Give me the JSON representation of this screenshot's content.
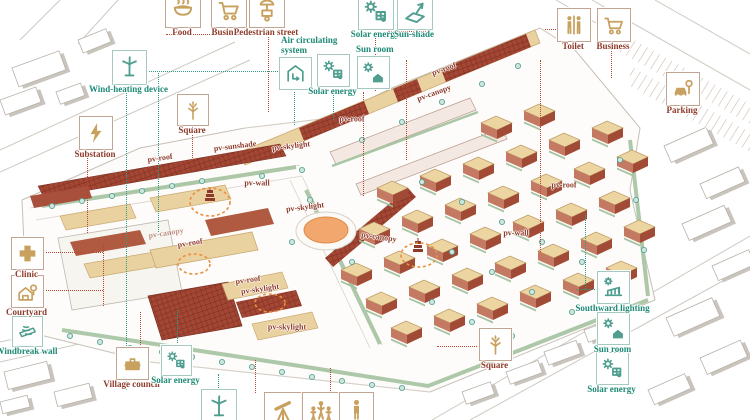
{
  "diagram": {
    "title": "Village masterplan energy-strategy axonometric diagram",
    "colors": {
      "teal_label": "#1e8a76",
      "red_label": "#8f3b2b",
      "tan_icon": "#c8a15e",
      "teal_icon": "#4f9e8f",
      "orange": "#e8913f",
      "pv_red": "#a34634",
      "roof_tan": "#ead1a0",
      "green_band": "#a9c6a4"
    },
    "callouts": [
      {
        "id": "food",
        "label": "Food",
        "icon": "food",
        "color": "red",
        "icon_color": "tan",
        "x": 165,
        "y": -8,
        "s": 34,
        "label_pos": "below"
      },
      {
        "id": "business-top",
        "label": "Business",
        "icon": "cart",
        "color": "red",
        "icon_color": "tan",
        "x": 211,
        "y": -8,
        "s": 34,
        "label_pos": "below"
      },
      {
        "id": "pedestrian-street",
        "label": "Pedestrian street",
        "icon": "vendor-cart",
        "color": "red",
        "icon_color": "tan",
        "x": 249,
        "y": -8,
        "s": 34,
        "label_pos": "below"
      },
      {
        "id": "solar-energy-top",
        "label": "Solar energy",
        "icon": "solar-panel",
        "color": "teal",
        "icon_color": "teal",
        "x": 358,
        "y": -6,
        "s": 34,
        "label_pos": "below"
      },
      {
        "id": "sun-shade",
        "label": "Sun-shade",
        "icon": "sun-shade",
        "color": "teal",
        "icon_color": "teal",
        "x": 397,
        "y": -6,
        "s": 34,
        "label_pos": "below"
      },
      {
        "id": "toilet",
        "label": "Toilet",
        "icon": "toilet",
        "color": "red",
        "icon_color": "tan",
        "x": 557,
        "y": 8,
        "s": 32,
        "label_pos": "below"
      },
      {
        "id": "business-right",
        "label": "Business",
        "icon": "cart",
        "color": "red",
        "icon_color": "tan",
        "x": 597,
        "y": 8,
        "s": 32,
        "label_pos": "below"
      },
      {
        "id": "parking",
        "label": "Parking",
        "icon": "car",
        "color": "red",
        "icon_color": "tan",
        "x": 666,
        "y": 72,
        "s": 32,
        "label_pos": "below"
      },
      {
        "id": "wind-heating",
        "label": "Wind-heating device",
        "icon": "wind-turbine",
        "color": "teal",
        "icon_color": "teal",
        "x": 112,
        "y": 50,
        "s": 33,
        "label_pos": "below"
      },
      {
        "id": "substation",
        "label": "Substation",
        "icon": "lightning",
        "color": "red",
        "icon_color": "tan",
        "x": 79,
        "y": 116,
        "s": 32,
        "label_pos": "below"
      },
      {
        "id": "square-left",
        "label": "Square",
        "icon": "tree",
        "color": "red",
        "icon_color": "tan",
        "x": 177,
        "y": 94,
        "s": 30,
        "label_pos": "below"
      },
      {
        "id": "air-circulating",
        "label": "Air circulating system",
        "icon": "air-house",
        "color": "teal",
        "icon_color": "teal",
        "x": 279,
        "y": 57,
        "s": 31,
        "label_pos": "above2"
      },
      {
        "id": "solar-energy-mid",
        "label": "Solar energy",
        "icon": "solar-panel",
        "color": "teal",
        "icon_color": "teal",
        "x": 317,
        "y": 54,
        "s": 31,
        "label_pos": "below"
      },
      {
        "id": "sun-room-mid",
        "label": "Sun room",
        "icon": "sun-house",
        "color": "teal",
        "icon_color": "teal",
        "x": 357,
        "y": 56,
        "s": 31,
        "label_pos": "above"
      },
      {
        "id": "clinic",
        "label": "Clinic",
        "icon": "cross",
        "color": "red",
        "icon_color": "tan",
        "x": 11,
        "y": 237,
        "s": 31,
        "label_pos": "below"
      },
      {
        "id": "courtyard",
        "label": "Courtyard",
        "icon": "courtyard-house",
        "color": "red",
        "icon_color": "tan",
        "x": 11,
        "y": 275,
        "s": 31,
        "label_pos": "below"
      },
      {
        "id": "windbreak-wall",
        "label": "Windbreak wall",
        "icon": "windbreak",
        "color": "teal",
        "icon_color": "teal",
        "x": 12,
        "y": 316,
        "s": 29,
        "label_pos": "below"
      },
      {
        "id": "village-council",
        "label": "Village council",
        "icon": "briefcase",
        "color": "red",
        "icon_color": "tan",
        "x": 116,
        "y": 347,
        "s": 31,
        "label_pos": "below"
      },
      {
        "id": "solar-energy-bl",
        "label": "Solar energy",
        "icon": "solar-panel",
        "color": "teal",
        "icon_color": "teal",
        "x": 161,
        "y": 345,
        "s": 29,
        "label_pos": "below"
      },
      {
        "id": "southward-lighting",
        "label": "Southward lighting",
        "icon": "south-light",
        "color": "teal",
        "icon_color": "teal",
        "x": 597,
        "y": 271,
        "s": 31,
        "label_pos": "below"
      },
      {
        "id": "sun-room-right",
        "label": "Sun room",
        "icon": "sun-house",
        "color": "teal",
        "icon_color": "teal",
        "x": 597,
        "y": 312,
        "s": 31,
        "label_pos": "below"
      },
      {
        "id": "solar-energy-right",
        "label": "Solar energy",
        "icon": "solar-panel",
        "color": "teal",
        "icon_color": "teal",
        "x": 596,
        "y": 352,
        "s": 31,
        "label_pos": "below"
      },
      {
        "id": "square-bottom",
        "label": "Square",
        "icon": "tree",
        "color": "red",
        "icon_color": "tan",
        "x": 479,
        "y": 328,
        "s": 31,
        "label_pos": "below"
      },
      {
        "id": "turbine-bottom",
        "label": "",
        "icon": "wind-turbine",
        "color": "teal",
        "icon_color": "teal",
        "x": 201,
        "y": 389,
        "s": 34,
        "label_pos": "none"
      },
      {
        "id": "telescope-bottom",
        "label": "",
        "icon": "telescope",
        "color": "red",
        "icon_color": "tan",
        "x": 264,
        "y": 392,
        "s": 36,
        "label_pos": "none"
      },
      {
        "id": "people-bottom",
        "label": "",
        "icon": "people",
        "color": "red",
        "icon_color": "tan",
        "x": 302,
        "y": 392,
        "s": 36,
        "label_pos": "none"
      },
      {
        "id": "person-bottom",
        "label": "",
        "icon": "person",
        "color": "red",
        "icon_color": "tan",
        "x": 339,
        "y": 392,
        "s": 33,
        "label_pos": "none"
      }
    ],
    "plan_labels": [
      {
        "text": "pv-roof",
        "x": 160,
        "y": 158,
        "rot": -8
      },
      {
        "text": "pv-sunshade",
        "x": 235,
        "y": 146,
        "rot": -7
      },
      {
        "text": "pv-skylight",
        "x": 291,
        "y": 146,
        "rot": -7
      },
      {
        "text": "pv-wall",
        "x": 257,
        "y": 183,
        "rot": 0
      },
      {
        "text": "pv-canopy",
        "x": 166,
        "y": 233,
        "rot": -9,
        "faint": true
      },
      {
        "text": "pv-roof",
        "x": 190,
        "y": 243,
        "rot": -9
      },
      {
        "text": "pv-roof",
        "x": 248,
        "y": 280,
        "rot": -8
      },
      {
        "text": "pv-skylight",
        "x": 260,
        "y": 289,
        "rot": -8
      },
      {
        "text": "pv-skylight",
        "x": 287,
        "y": 327,
        "rot": 0
      },
      {
        "text": "pv-skylight",
        "x": 305,
        "y": 207,
        "rot": -7
      },
      {
        "text": "pv-canopy",
        "x": 379,
        "y": 237,
        "rot": 8
      },
      {
        "text": "pv-roof",
        "x": 444,
        "y": 69,
        "rot": -20
      },
      {
        "text": "pv-canopy",
        "x": 434,
        "y": 93,
        "rot": -20
      },
      {
        "text": "pv-roof",
        "x": 352,
        "y": 119,
        "rot": 0
      },
      {
        "text": "pv-roof",
        "x": 564,
        "y": 185,
        "rot": 0
      },
      {
        "text": "pv-wall",
        "x": 516,
        "y": 233,
        "rot": 0
      }
    ],
    "connectors": [
      {
        "x": 166,
        "y": 34,
        "len": 82,
        "dir": "h",
        "c": "red"
      },
      {
        "x": 268,
        "y": 34,
        "len": 78,
        "dir": "v",
        "c": "red"
      },
      {
        "x": 375,
        "y": 33,
        "len": 58,
        "dir": "v",
        "c": "red"
      },
      {
        "x": 388,
        "y": 31,
        "len": 40,
        "dir": "h",
        "c": "red"
      },
      {
        "x": 545,
        "y": 29,
        "len": 13,
        "dir": "h",
        "c": "red"
      },
      {
        "x": 611,
        "y": 47,
        "len": 31,
        "dir": "v",
        "c": "red"
      },
      {
        "x": 87,
        "y": 153,
        "len": 80,
        "dir": "v",
        "c": "red"
      },
      {
        "x": 192,
        "y": 126,
        "len": 34,
        "dir": "v",
        "c": "red"
      },
      {
        "x": 43,
        "y": 252,
        "len": 60,
        "dir": "h",
        "c": "red"
      },
      {
        "x": 103,
        "y": 244,
        "len": 62,
        "dir": "v",
        "c": "red"
      },
      {
        "x": 44,
        "y": 290,
        "len": 59,
        "dir": "h",
        "c": "red"
      },
      {
        "x": 437,
        "y": 346,
        "len": 42,
        "dir": "h",
        "c": "red"
      },
      {
        "x": 140,
        "y": 312,
        "len": 35,
        "dir": "v",
        "c": "red"
      },
      {
        "x": 255,
        "y": 360,
        "len": 33,
        "dir": "v",
        "c": "red"
      },
      {
        "x": 330,
        "y": 368,
        "len": 25,
        "dir": "v",
        "c": "red"
      },
      {
        "x": 363,
        "y": 92,
        "len": 104,
        "dir": "v",
        "c": "red"
      },
      {
        "x": 406,
        "y": 60,
        "len": 100,
        "dir": "v",
        "c": "red"
      },
      {
        "x": 540,
        "y": 60,
        "len": 192,
        "dir": "v",
        "c": "red"
      },
      {
        "x": 146,
        "y": 71,
        "len": 154,
        "dir": "h",
        "c": "teal"
      },
      {
        "x": 126,
        "y": 84,
        "len": 306,
        "dir": "v",
        "c": "teal"
      },
      {
        "x": 158,
        "y": 73,
        "len": 159,
        "dir": "v",
        "c": "teal"
      },
      {
        "x": 576,
        "y": 289,
        "len": 21,
        "dir": "h",
        "c": "teal"
      },
      {
        "x": 585,
        "y": 215,
        "len": 74,
        "dir": "v",
        "c": "teal"
      },
      {
        "x": 177,
        "y": 310,
        "len": 35,
        "dir": "v",
        "c": "teal"
      },
      {
        "x": 218,
        "y": 374,
        "len": 16,
        "dir": "v",
        "c": "teal"
      },
      {
        "x": 294,
        "y": 89,
        "len": 36,
        "dir": "v",
        "c": "teal"
      },
      {
        "x": 333,
        "y": 86,
        "len": 34,
        "dir": "v",
        "c": "teal"
      }
    ],
    "highlight_ellipses": [
      {
        "cx": 210,
        "cy": 202,
        "rx": 20,
        "ry": 14,
        "filled": false
      },
      {
        "cx": 194,
        "cy": 264,
        "rx": 16,
        "ry": 10,
        "filled": false
      },
      {
        "cx": 270,
        "cy": 303,
        "rx": 15,
        "ry": 9,
        "filled": false
      },
      {
        "cx": 326,
        "cy": 230,
        "rx": 22,
        "ry": 13,
        "filled": true
      },
      {
        "cx": 419,
        "cy": 255,
        "rx": 18,
        "ry": 12,
        "filled": false
      }
    ]
  }
}
